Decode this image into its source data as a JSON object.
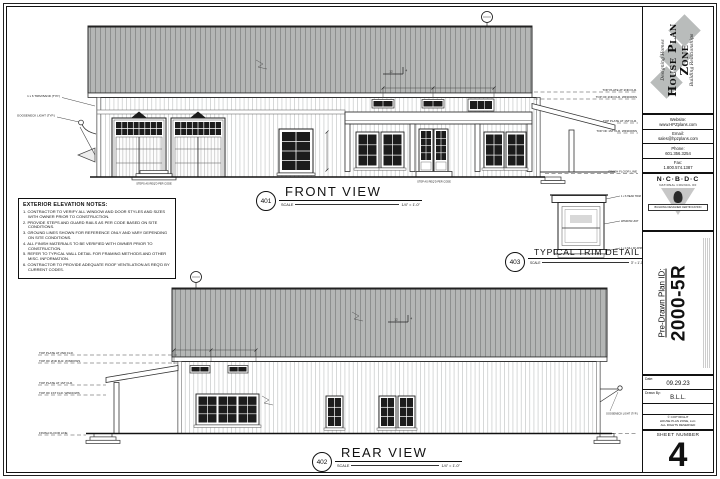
{
  "sheet": {
    "views": {
      "front": {
        "number": "401",
        "title": "FRONT VIEW",
        "scale_label": "SCALE",
        "scale_value": "1/4\" = 1'-0\""
      },
      "rear": {
        "number": "402",
        "title": "REAR VIEW",
        "scale_label": "SCALE",
        "scale_value": "1/4\" = 1'-0\""
      },
      "trim": {
        "number": "403",
        "title": "TYPICAL TRIM DETAIL",
        "scale_label": "SCALE",
        "scale_value": "3\" = 1'-0\""
      }
    },
    "notes": {
      "title": "EXTERIOR ELEVATION NOTES:",
      "items": [
        "1. CONTRACTOR TO VERIFY ALL WINDOW AND DOOR STYLES AND SIZES WITH OWNER PRIOR TO CONSTRUCTION.",
        "2. PROVIDE STEPS AND GUARD RAILS AS PER CODE BASED ON SITE CONDITIONS.",
        "3. GROUND LINES SHOWN FOR REFERENCE ONLY AND VARY DEPENDING ON SITE CONDITIONS.",
        "4. ALL FINISH MATERIALS TO BE VERIFIED WITH OWNER PRIOR TO CONSTRUCTION.",
        "5. REFER TO TYPICAL WALL DETAIL FOR FRAMING METHODS AND OTHER MISC. INFORMATION.",
        "6. CONTRACTOR TO PROVIDE ADEQUATE ROOF VENTILATION AS REQ'D BY CURRENT CODES."
      ]
    },
    "elevation_labels": {
      "top_plate_2nd": "TOP PLATE AT 2ND FLR.",
      "top_2nd_windows": "TOP OF 2ND FLR. WINDOWS",
      "top_plate_1st": "TOP PLATE AT 1ST FLR.",
      "top_1st_windows": "TOP OF 1ST FLR. WINDOWS",
      "finish_floor": "FINISH FLOOR LINE"
    },
    "callouts": {
      "trim_band": "1 x 6 TRIM BAND (TYP.)",
      "gooseneck": "GOOSENECK LIGHT (TYP.)",
      "steps": "STEPS AS REQ'D PER CODE",
      "step": "STEP AS REQ'D PER CODE",
      "head_trim": "1 x 6 HEAD TRIM",
      "window_unit": "WINDOW UNIT",
      "sill_trim": "1 x 4 SILL W/ APRON"
    },
    "pitch": {
      "run": "12",
      "rise": "4"
    }
  },
  "title_block": {
    "brand": {
      "tagline_top": "Designing Homes",
      "name": "House Plan Zone",
      "tagline_bottom": "Building Relationships"
    },
    "contact": [
      {
        "label": "Website:",
        "value": "www.HPZplans.com"
      },
      {
        "label": "Email:",
        "value": "sales@hpzplans.com"
      },
      {
        "label": "Phone:",
        "value": "601.356.3254"
      },
      {
        "label": "Fax:",
        "value": "1.800.574.1387"
      }
    ],
    "certification": {
      "name": "N·C·B·D·C",
      "subtitle": "NATIONAL COUNCIL OF",
      "banner": "BUILDING DESIGNER CERTIFICATION"
    },
    "plan": {
      "label": "Pre-Drawn Plan ID:",
      "id": "2000-5R"
    },
    "date": {
      "label": "Date:",
      "value": "09.29.23"
    },
    "drawn_by": {
      "label": "Drawn By:",
      "value": "B.L.L."
    },
    "copyright": {
      "line1": "© COPYRIGHT",
      "line2": "HOUSE PLAN ZONE, LLC.",
      "line3": "ALL RIGHTS RESERVED"
    },
    "sheet": {
      "label": "SHEET NUMBER",
      "number": "4"
    }
  }
}
